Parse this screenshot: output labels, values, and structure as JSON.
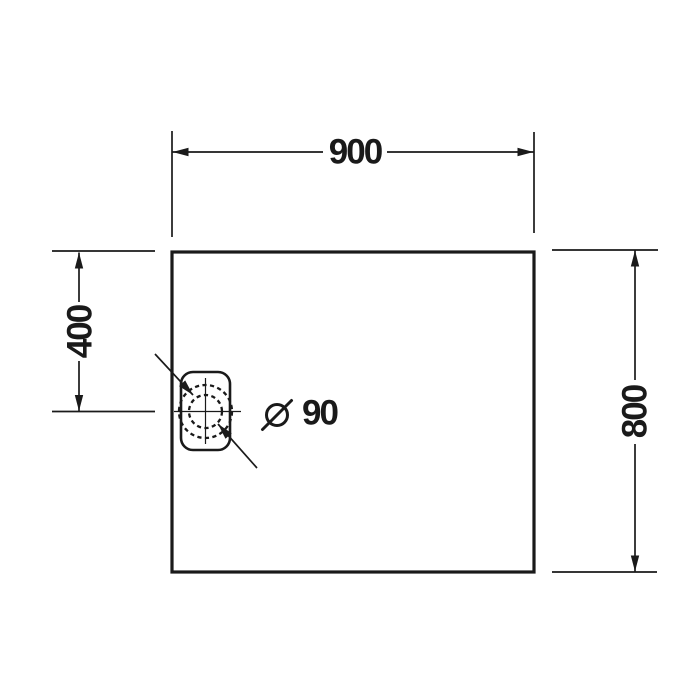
{
  "drawing": {
    "colors": {
      "line": "#1a1a1a",
      "background": "#ffffff"
    },
    "labels": {
      "width": "900",
      "height": "800",
      "drain_offset": "400",
      "drain_diameter": "Ø 90",
      "drain_diameter_value": "90"
    }
  }
}
